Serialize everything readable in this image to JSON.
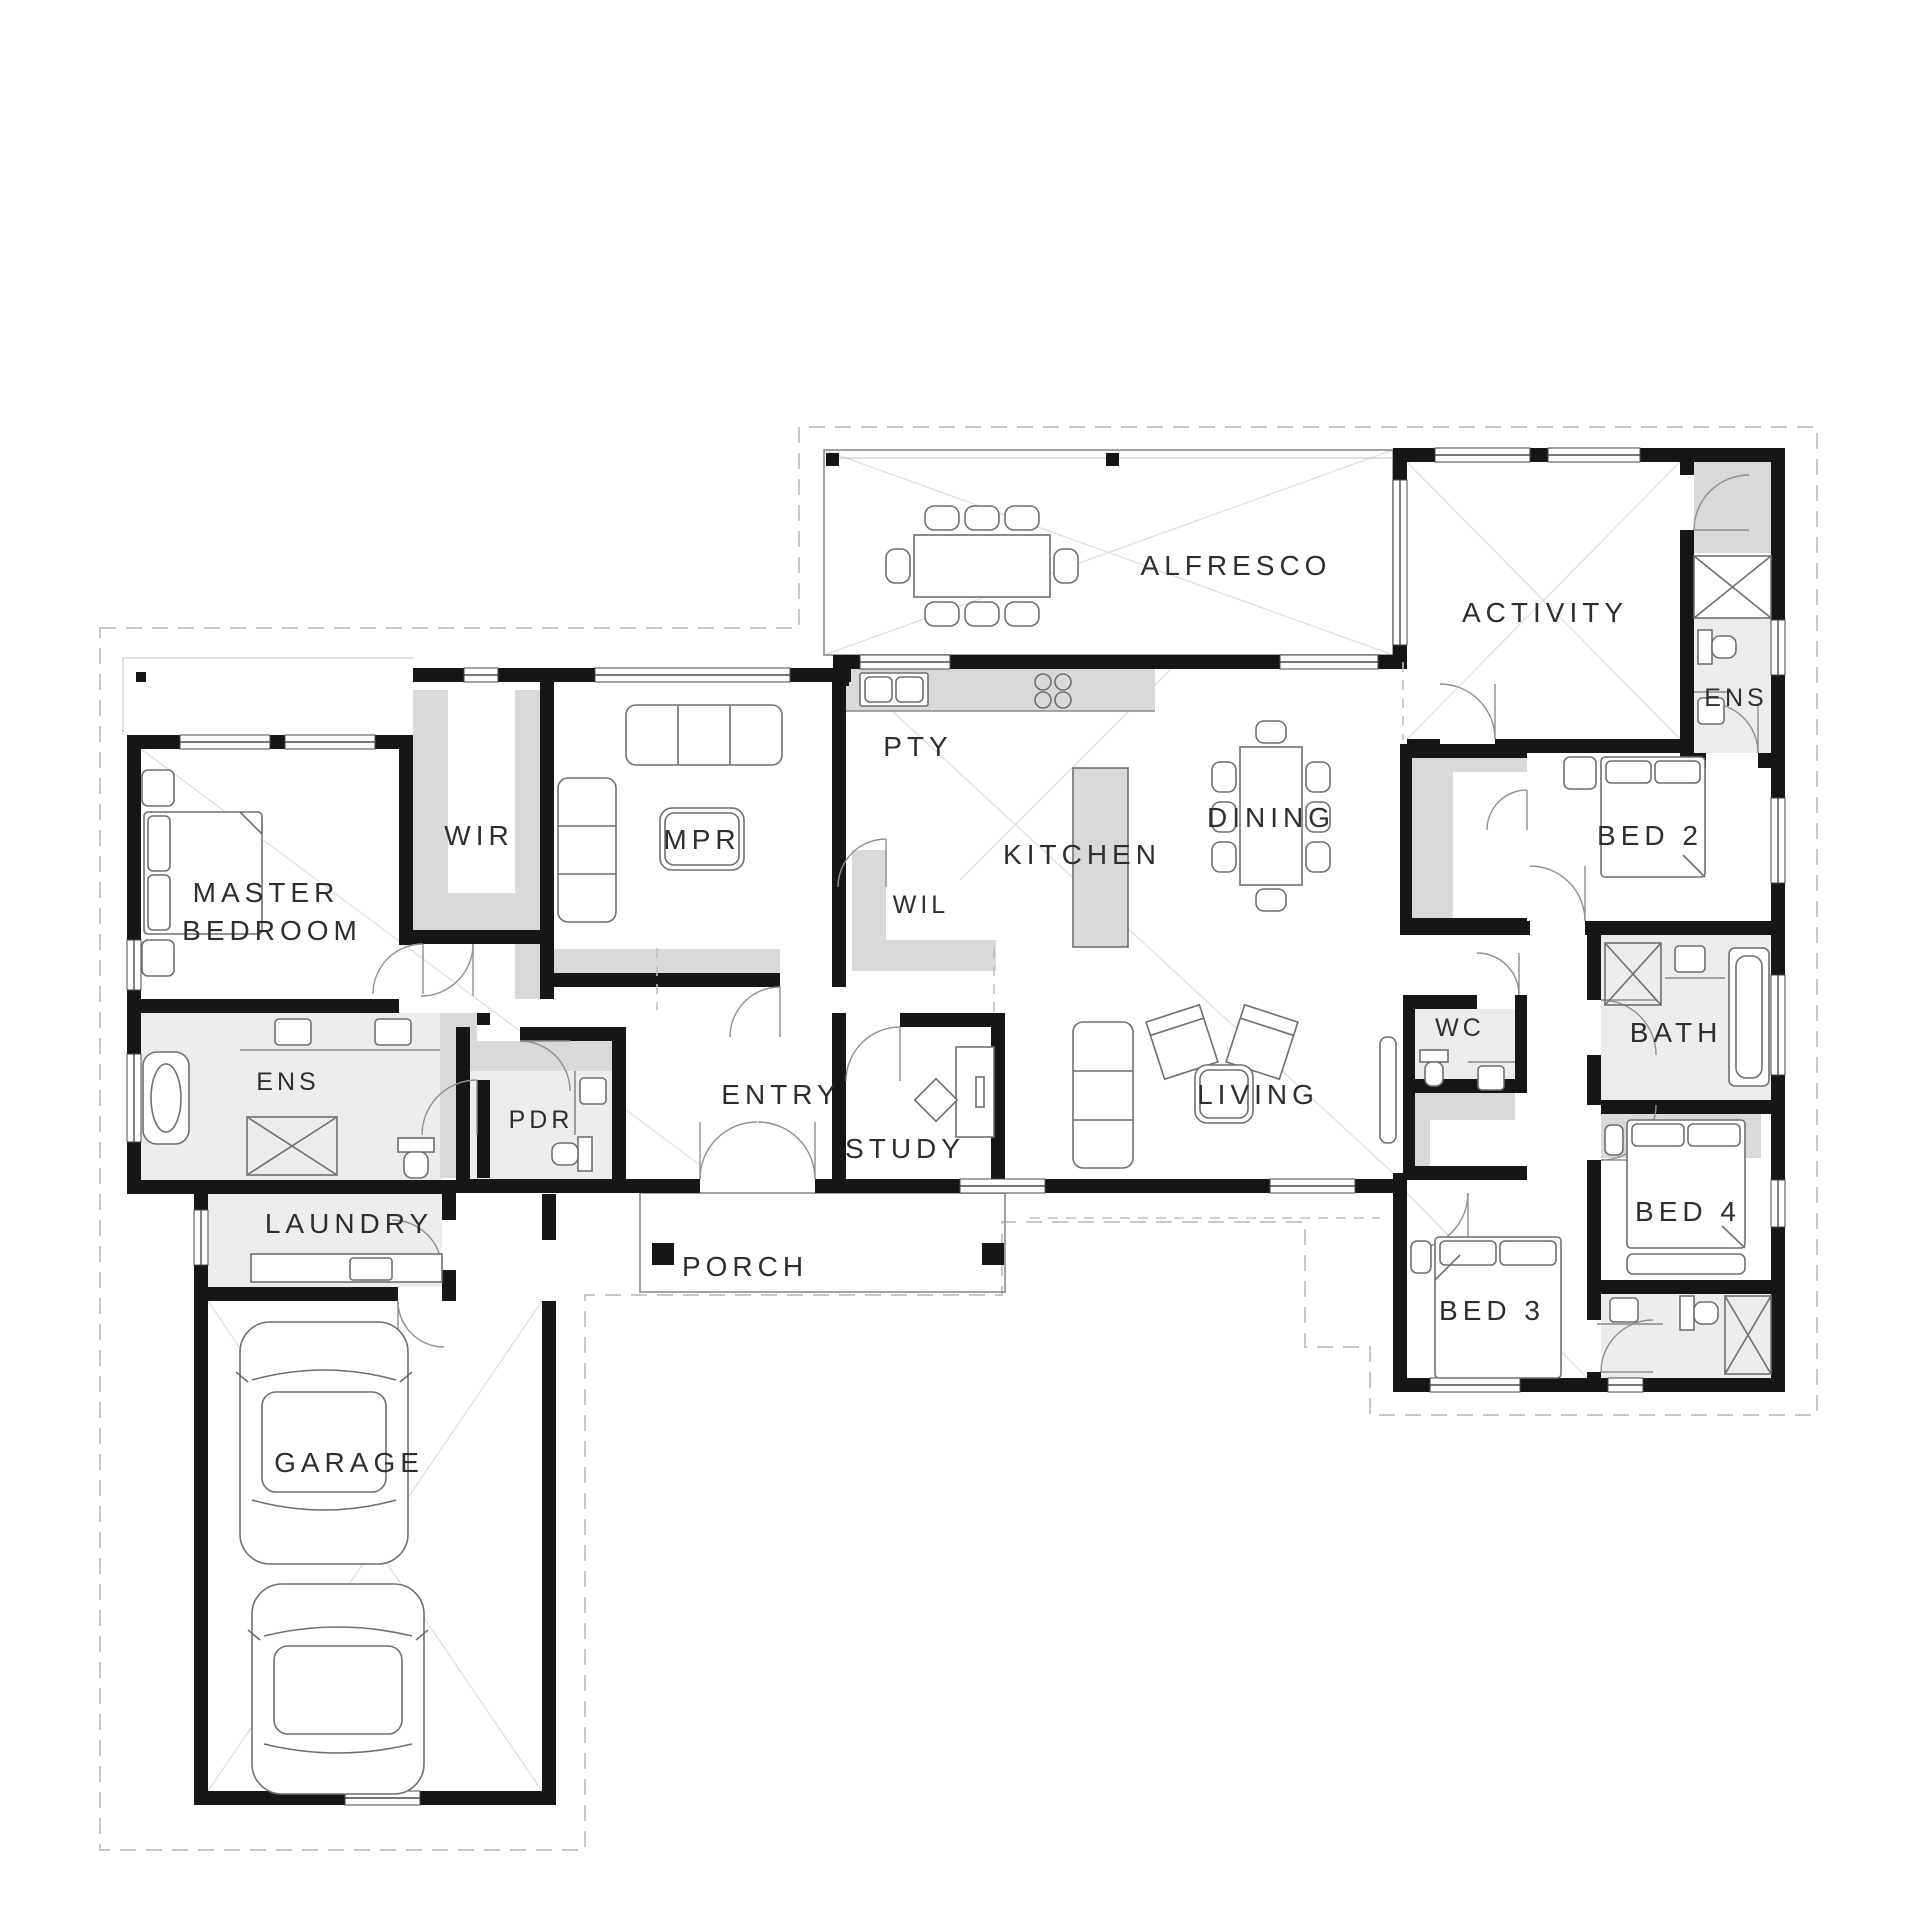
{
  "plan": {
    "colors": {
      "wall": "#161616",
      "shading": "#d9d9d9",
      "wet_area_tile": "#ececec",
      "background": "#ffffff"
    }
  },
  "labels": {
    "master_line1": "MASTER",
    "master_line2": "BEDROOM",
    "wir": "WIR",
    "mpr": "MPR",
    "pty": "PTY",
    "wil": "WIL",
    "kitchen": "KITCHEN",
    "dining": "DINING",
    "alfresco": "ALFRESCO",
    "activity": "ACTIVITY",
    "ens_activity": "ENS",
    "bed2": "BED 2",
    "entry": "ENTRY",
    "study": "STUDY",
    "living": "LIVING",
    "wc": "WC",
    "bath": "BATH",
    "pdr": "PDR",
    "ens_master": "ENS",
    "laundry": "LAUNDRY",
    "porch": "PORCH",
    "bed3": "BED 3",
    "bed4": "BED 4",
    "garage": "GARAGE"
  }
}
